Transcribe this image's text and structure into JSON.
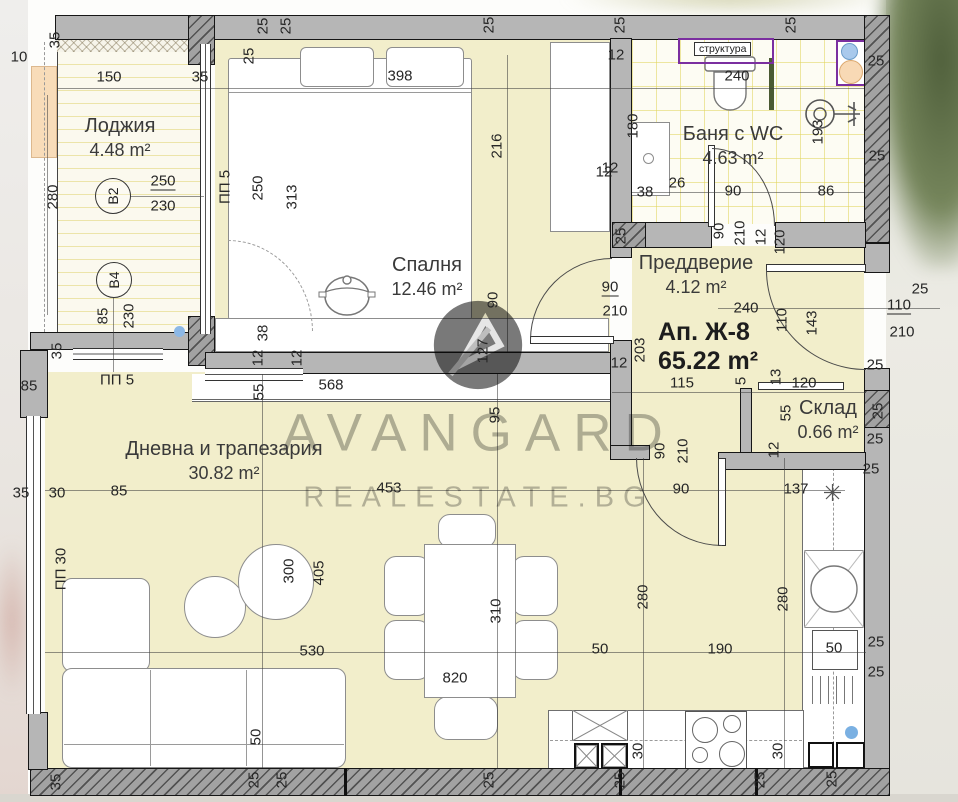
{
  "plan": {
    "apartment_label": "Ап. Ж-8",
    "apartment_area": "65.22 m²",
    "rooms": [
      {
        "name": "Лоджия",
        "area": "4.48 m²"
      },
      {
        "name": "Спалня",
        "area": "12.46 m²"
      },
      {
        "name": "Баня с WC",
        "area": "4.63 m²"
      },
      {
        "name": "Преддверие",
        "area": "4.12 m²"
      },
      {
        "name": "Склад",
        "area": "0.66 m²"
      },
      {
        "name": "Дневна и трапезария",
        "area": "30.82 m²"
      }
    ],
    "badges": [
      {
        "label": "B2"
      },
      {
        "label": "B4"
      }
    ],
    "niche_label": "структура"
  },
  "watermark": {
    "brand": "AVANGARD",
    "site": "REALESTATE.BG"
  },
  "colors": {
    "floor_yellow": "#f2eecb",
    "wall_gray": "#b6b6b6",
    "line_dark": "#161616",
    "tile_line": "#e0d45a",
    "niche_purple": "#7b2fa0",
    "peach": "#f8dcb9",
    "blue_dot": "#8cb8e6",
    "watermark_gray": "#7d7d7d"
  },
  "labels": [
    {
      "t": "35",
      "x": 55,
      "y": 40,
      "r": -90
    },
    {
      "t": "10",
      "x": 19,
      "y": 57
    },
    {
      "t": "150",
      "x": 109,
      "y": 77
    },
    {
      "t": "35",
      "x": 200,
      "y": 77
    },
    {
      "t": "398",
      "x": 400,
      "y": 76
    },
    {
      "t": "25",
      "x": 249,
      "y": 56,
      "r": -90
    },
    {
      "t": "25",
      "x": 263,
      "y": 26,
      "r": -90
    },
    {
      "t": "25",
      "x": 286,
      "y": 26,
      "r": -90
    },
    {
      "t": "25",
      "x": 489,
      "y": 25,
      "r": -90
    },
    {
      "t": "25",
      "x": 620,
      "y": 25,
      "r": -90
    },
    {
      "t": "25",
      "x": 791,
      "y": 25,
      "r": -90
    },
    {
      "t": "280",
      "x": 53,
      "y": 197,
      "r": -90
    },
    {
      "t": "250",
      "x": 163,
      "y": 182,
      "u": true
    },
    {
      "t": "230",
      "x": 163,
      "y": 206
    },
    {
      "t": "250",
      "x": 258,
      "y": 188,
      "r": -90
    },
    {
      "t": "313",
      "x": 292,
      "y": 197,
      "r": -90
    },
    {
      "t": "216",
      "x": 497,
      "y": 146,
      "r": -90
    },
    {
      "t": "12",
      "x": 616,
      "y": 55
    },
    {
      "t": "12",
      "x": 610,
      "y": 168
    },
    {
      "t": "85",
      "x": 103,
      "y": 316,
      "r": -90
    },
    {
      "t": "230",
      "x": 129,
      "y": 316,
      "r": -90
    },
    {
      "t": "35",
      "x": 57,
      "y": 351,
      "r": -90
    },
    {
      "t": "85",
      "x": 29,
      "y": 386
    },
    {
      "t": "38",
      "x": 263,
      "y": 333,
      "r": -90
    },
    {
      "t": "12",
      "x": 258,
      "y": 358,
      "r": -90
    },
    {
      "t": "12",
      "x": 297,
      "y": 358,
      "r": -90
    },
    {
      "t": "55",
      "x": 259,
      "y": 392,
      "r": -90
    },
    {
      "t": "568",
      "x": 331,
      "y": 385
    },
    {
      "t": "90",
      "x": 493,
      "y": 300,
      "r": -90
    },
    {
      "t": "127",
      "x": 483,
      "y": 351,
      "r": -90
    },
    {
      "t": "95",
      "x": 495,
      "y": 415,
      "r": -90
    },
    {
      "t": "90",
      "x": 610,
      "y": 288,
      "u": true
    },
    {
      "t": "210",
      "x": 615,
      "y": 311
    },
    {
      "t": "203",
      "x": 640,
      "y": 350,
      "r": -90
    },
    {
      "t": "12",
      "x": 619,
      "y": 363
    },
    {
      "t": "25",
      "x": 621,
      "y": 236,
      "r": -90
    },
    {
      "t": "240",
      "x": 737,
      "y": 76
    },
    {
      "t": "180",
      "x": 633,
      "y": 126,
      "r": -90
    },
    {
      "t": "12",
      "x": 604,
      "y": 172
    },
    {
      "t": "38",
      "x": 645,
      "y": 192
    },
    {
      "t": "26",
      "x": 677,
      "y": 183
    },
    {
      "t": "90",
      "x": 733,
      "y": 191
    },
    {
      "t": "86",
      "x": 826,
      "y": 191
    },
    {
      "t": "193",
      "x": 818,
      "y": 132,
      "r": -90
    },
    {
      "t": "90",
      "x": 719,
      "y": 231,
      "r": -90
    },
    {
      "t": "210",
      "x": 740,
      "y": 233,
      "r": -90
    },
    {
      "t": "12",
      "x": 761,
      "y": 237,
      "r": -90
    },
    {
      "t": "120",
      "x": 780,
      "y": 242,
      "r": -90
    },
    {
      "t": "25",
      "x": 876,
      "y": 61
    },
    {
      "t": "25",
      "x": 877,
      "y": 156
    },
    {
      "t": "240",
      "x": 746,
      "y": 308
    },
    {
      "t": "110",
      "x": 782,
      "y": 320,
      "r": -90
    },
    {
      "t": "143",
      "x": 812,
      "y": 323,
      "r": -90
    },
    {
      "t": "25",
      "x": 920,
      "y": 289
    },
    {
      "t": "110",
      "x": 899,
      "y": 306,
      "u": true
    },
    {
      "t": "210",
      "x": 902,
      "y": 332
    },
    {
      "t": "115",
      "x": 682,
      "y": 383
    },
    {
      "t": "5",
      "x": 741,
      "y": 381,
      "r": -90
    },
    {
      "t": "13",
      "x": 776,
      "y": 377,
      "r": -90
    },
    {
      "t": "120",
      "x": 804,
      "y": 383
    },
    {
      "t": "90",
      "x": 660,
      "y": 451,
      "r": -90
    },
    {
      "t": "210",
      "x": 683,
      "y": 451,
      "r": -90
    },
    {
      "t": "55",
      "x": 786,
      "y": 413,
      "r": -90
    },
    {
      "t": "12",
      "x": 774,
      "y": 450,
      "r": -90
    },
    {
      "t": "25",
      "x": 875,
      "y": 365
    },
    {
      "t": "25",
      "x": 878,
      "y": 411,
      "r": -90
    },
    {
      "t": "25",
      "x": 875,
      "y": 439
    },
    {
      "t": "25",
      "x": 871,
      "y": 469
    },
    {
      "t": "35",
      "x": 21,
      "y": 493
    },
    {
      "t": "30",
      "x": 57,
      "y": 493
    },
    {
      "t": "85",
      "x": 119,
      "y": 491
    },
    {
      "t": "453",
      "x": 389,
      "y": 488
    },
    {
      "t": "90",
      "x": 681,
      "y": 489
    },
    {
      "t": "137",
      "x": 796,
      "y": 489
    },
    {
      "t": "300",
      "x": 289,
      "y": 571,
      "r": -90
    },
    {
      "t": "405",
      "x": 319,
      "y": 573,
      "r": -90
    },
    {
      "t": "530",
      "x": 312,
      "y": 651
    },
    {
      "t": "50",
      "x": 256,
      "y": 737,
      "r": -90
    },
    {
      "t": "310",
      "x": 496,
      "y": 611,
      "r": -90
    },
    {
      "t": "820",
      "x": 455,
      "y": 678
    },
    {
      "t": "50",
      "x": 600,
      "y": 649
    },
    {
      "t": "190",
      "x": 720,
      "y": 649
    },
    {
      "t": "280",
      "x": 643,
      "y": 597,
      "r": -90
    },
    {
      "t": "280",
      "x": 783,
      "y": 599,
      "r": -90
    },
    {
      "t": "30",
      "x": 638,
      "y": 751,
      "r": -90
    },
    {
      "t": "30",
      "x": 778,
      "y": 751,
      "r": -90
    },
    {
      "t": "50",
      "x": 834,
      "y": 648
    },
    {
      "t": "25",
      "x": 876,
      "y": 642
    },
    {
      "t": "25",
      "x": 876,
      "y": 672
    },
    {
      "t": "35",
      "x": 56,
      "y": 782,
      "r": -90
    },
    {
      "t": "25",
      "x": 254,
      "y": 780,
      "r": -90
    },
    {
      "t": "25",
      "x": 282,
      "y": 780,
      "r": -90
    },
    {
      "t": "25",
      "x": 489,
      "y": 780,
      "r": -90
    },
    {
      "t": "25",
      "x": 620,
      "y": 780,
      "r": -90
    },
    {
      "t": "25",
      "x": 760,
      "y": 780,
      "r": -90
    },
    {
      "t": "25",
      "x": 832,
      "y": 779,
      "r": -90
    },
    {
      "t": "ПП 5",
      "x": 225,
      "y": 187,
      "r": -90
    },
    {
      "t": "ПП 5",
      "x": 117,
      "y": 380
    },
    {
      "t": "ПП 30",
      "x": 61,
      "y": 569,
      "r": -90
    }
  ]
}
